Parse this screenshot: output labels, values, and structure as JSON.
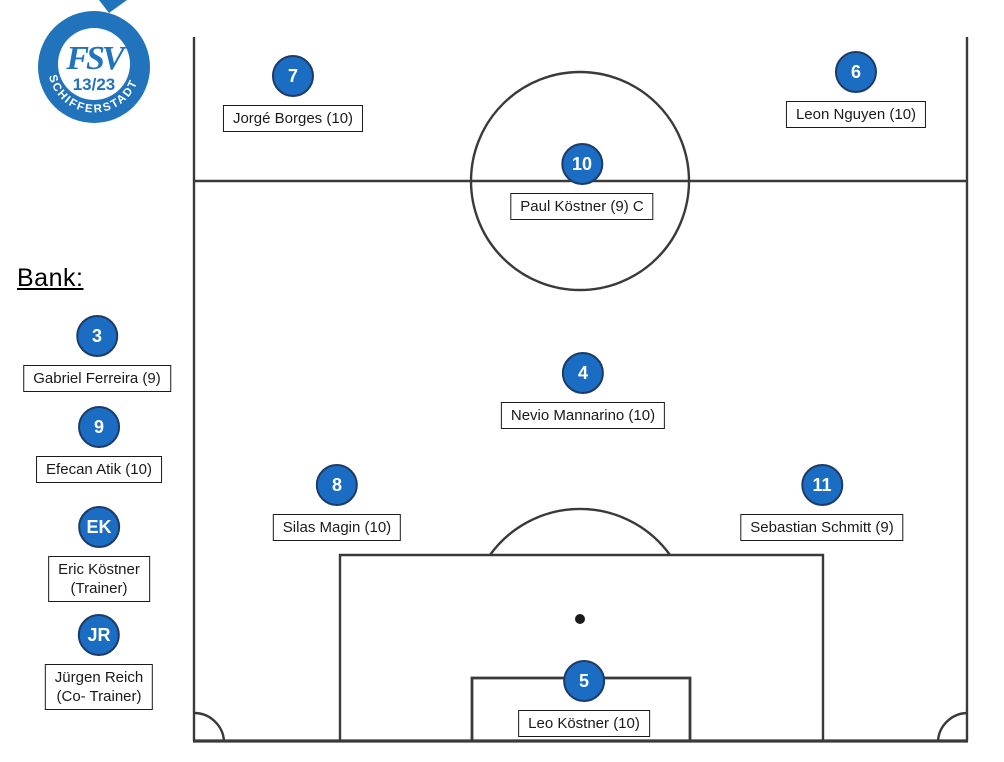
{
  "logo": {
    "club_initials": "FSV",
    "club_numbers": "13/23",
    "club_city": "SCHIFFERSTADT"
  },
  "bench": {
    "title": "Bank:",
    "items": [
      {
        "number": "3",
        "name": "Gabriel Ferreira (9)"
      },
      {
        "number": "9",
        "name": "Efecan Atik (10)"
      },
      {
        "number": "EK",
        "name": "Eric Köstner",
        "role": "(Trainer)"
      },
      {
        "number": "JR",
        "name": "Jürgen Reich",
        "role": "(Co- Trainer)"
      }
    ]
  },
  "lineup": {
    "players": [
      {
        "number": "7",
        "name": "Jorgé Borges (10)"
      },
      {
        "number": "6",
        "name": "Leon Nguyen (10)"
      },
      {
        "number": "10",
        "name": "Paul Köstner (9) C"
      },
      {
        "number": "4",
        "name": "Nevio Mannarino (10)"
      },
      {
        "number": "8",
        "name": "Silas Magin (10)"
      },
      {
        "number": "11",
        "name": "Sebastian Schmitt (9)"
      },
      {
        "number": "5",
        "name": "Leo Köstner (10)"
      }
    ]
  },
  "colors": {
    "marker_fill": "#1a6dc3",
    "marker_border": "#1e3a66",
    "marker_number": "#ffffff",
    "pitch_line": "#3a3a3a",
    "label_border": "#1a1a1a",
    "logo_blue": "#2173bb"
  }
}
